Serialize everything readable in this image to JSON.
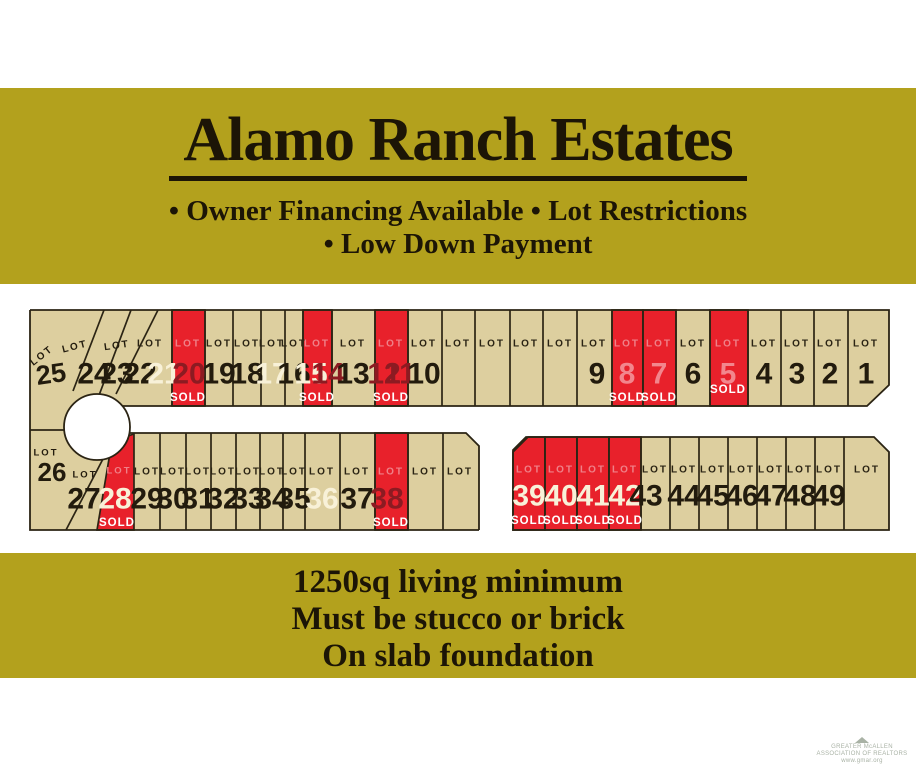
{
  "header": {
    "title": "Alamo Ranch Estates",
    "bullets_line1": "• Owner Financing Available • Lot Restrictions",
    "bullets_line2": "• Low Down Payment"
  },
  "footer_banner": {
    "line1": "1250sq living minimum",
    "line2": "Must be stucco or brick",
    "line3": "On slab foundation"
  },
  "watermark": {
    "line1": "GREATER McALLEN",
    "line2": "ASSOCIATION OF REALTORS",
    "line3": "www.gmar.org"
  },
  "colors": {
    "banner_bg": "#b3a11d",
    "banner_text": "#1c1506",
    "lot_tan": "#ddcf9f",
    "lot_red": "#e8212b",
    "outline": "#2b2414",
    "num_dark": "#221b0d",
    "num_white": "#f8f1d8",
    "num_maroon": "#8c1b22",
    "num_pink": "#f2868d",
    "lot_label_on_red": "#ef8088",
    "sold_text": "#ffffff",
    "watermark": "#a9b2a5",
    "road_white": "#ffffff"
  },
  "map": {
    "lot_word": "LOT",
    "sold_word": "SOLD",
    "sold_lot_numbers": [
      20,
      15,
      14,
      12,
      11,
      8,
      7,
      5,
      28,
      38,
      39,
      40,
      41,
      42
    ],
    "white_number_lots": [
      21,
      17,
      15,
      36
    ],
    "geometry": {
      "tan_polys": [
        "30,310 889,310 889,385 867,406 30,406",
        "30,406 96,406 96,530 30,530",
        "62,433 466,433 479,446 479,530 62,530",
        "526,437 874,437 889,452 889,530 513,530 513,450"
      ],
      "outline_paths": [
        "M30,310 H889 V385 L867,406 H123",
        "M30,310 V530 H479",
        "M129,433 H466 L479,446 V530",
        "M513,450 L526,437 H874 L889,452 V530 H513 Z",
        "M30,430 H64"
      ],
      "slant_lines": [
        [
          104,
          310,
          73,
          391
        ],
        [
          131,
          310,
          95,
          406
        ],
        [
          158,
          310,
          116,
          394
        ],
        [
          104,
          457,
          66,
          530
        ]
      ],
      "red_wedge": "112,441 134,434 134,530 97,530",
      "circle": {
        "cx": 97,
        "cy": 427,
        "r": 33
      }
    },
    "rows": [
      {
        "name": "top-row",
        "y": 310,
        "h": 96,
        "num_y": 374,
        "lot_y": 344,
        "sold_y": 398,
        "dividers": [
          172,
          205,
          233,
          261,
          285,
          303,
          332,
          375,
          408,
          442,
          475,
          510,
          543,
          577,
          612,
          643,
          676,
          710,
          748,
          781,
          814,
          848
        ],
        "red_cells": [
          {
            "x": 172,
            "w": 33
          },
          {
            "x": 303,
            "w": 29
          },
          {
            "x": 375,
            "w": 33
          },
          {
            "x": 612,
            "w": 31
          },
          {
            "x": 643,
            "w": 33
          },
          {
            "x": 710,
            "w": 38,
            "sold_y": 390
          }
        ],
        "lot_labels": [
          {
            "cx": 150
          },
          {
            "cx": 188,
            "on_red": true
          },
          {
            "cx": 219
          },
          {
            "cx": 247
          },
          {
            "cx": 272
          },
          {
            "cx": 294
          },
          {
            "cx": 317,
            "on_red": true
          },
          {
            "cx": 353
          },
          {
            "cx": 391,
            "on_red": true
          },
          {
            "cx": 424
          },
          {
            "cx": 458
          },
          {
            "cx": 492
          },
          {
            "cx": 526
          },
          {
            "cx": 560
          },
          {
            "cx": 594
          },
          {
            "cx": 627,
            "on_red": true
          },
          {
            "cx": 659,
            "on_red": true
          },
          {
            "cx": 693
          },
          {
            "cx": 728,
            "on_red": true
          },
          {
            "cx": 764
          },
          {
            "cx": 797
          },
          {
            "cx": 830
          },
          {
            "cx": 866
          }
        ],
        "numbers": [
          {
            "t": "24",
            "cx": 94,
            "c": "dark"
          },
          {
            "t": "23",
            "cx": 117,
            "c": "dark"
          },
          {
            "t": "22",
            "cx": 140,
            "c": "dark"
          },
          {
            "t": "21",
            "cx": 164,
            "c": "white"
          },
          {
            "t": "20",
            "cx": 189,
            "c": "maroon"
          },
          {
            "t": "19",
            "cx": 219,
            "c": "dark"
          },
          {
            "t": "18",
            "cx": 247,
            "c": "dark"
          },
          {
            "t": "17",
            "cx": 272,
            "c": "white"
          },
          {
            "t": "16",
            "cx": 294,
            "c": "dark"
          },
          {
            "t": "15",
            "cx": 311,
            "c": "white"
          },
          {
            "t": "14",
            "cx": 328,
            "c": "maroon"
          },
          {
            "t": "13",
            "cx": 353,
            "c": "dark"
          },
          {
            "t": "12",
            "cx": 384,
            "c": "maroon"
          },
          {
            "t": "11",
            "cx": 400,
            "c": "maroon"
          },
          {
            "t": "10",
            "cx": 424,
            "c": "dark"
          },
          {
            "t": "9",
            "cx": 597,
            "c": "dark"
          },
          {
            "t": "8",
            "cx": 627,
            "c": "pink"
          },
          {
            "t": "7",
            "cx": 659,
            "c": "pink"
          },
          {
            "t": "6",
            "cx": 693,
            "c": "dark"
          },
          {
            "t": "5",
            "cx": 728,
            "c": "pink"
          },
          {
            "t": "4",
            "cx": 764,
            "c": "dark"
          },
          {
            "t": "3",
            "cx": 797,
            "c": "dark"
          },
          {
            "t": "2",
            "cx": 830,
            "c": "dark"
          },
          {
            "t": "1",
            "cx": 866,
            "c": "dark"
          }
        ],
        "solds": [
          {
            "cx": 188
          },
          {
            "cx": 317
          },
          {
            "cx": 391
          },
          {
            "cx": 627
          },
          {
            "cx": 659
          },
          {
            "cx": 728,
            "y": 390
          }
        ]
      },
      {
        "name": "bottom-left-block",
        "y": 433,
        "h": 97,
        "num_y": 499,
        "lot_y": 472,
        "sold_y": 523,
        "dividers": [
          160,
          186,
          211,
          236,
          260,
          283,
          305,
          340,
          375,
          408,
          443
        ],
        "red_cells": [
          {
            "x": 375,
            "w": 33
          }
        ],
        "lot_labels": [
          {
            "cx": 147
          },
          {
            "cx": 173
          },
          {
            "cx": 198
          },
          {
            "cx": 223
          },
          {
            "cx": 248
          },
          {
            "cx": 272
          },
          {
            "cx": 294
          },
          {
            "cx": 322
          },
          {
            "cx": 357
          },
          {
            "cx": 391,
            "on_red": true
          },
          {
            "cx": 425
          },
          {
            "cx": 460
          }
        ],
        "numbers": [
          {
            "t": "29",
            "cx": 147,
            "c": "dark"
          },
          {
            "t": "30",
            "cx": 173,
            "c": "dark"
          },
          {
            "t": "31",
            "cx": 198,
            "c": "dark"
          },
          {
            "t": "32",
            "cx": 223,
            "c": "dark"
          },
          {
            "t": "33",
            "cx": 248,
            "c": "dark"
          },
          {
            "t": "34",
            "cx": 272,
            "c": "dark"
          },
          {
            "t": "35",
            "cx": 294,
            "c": "dark"
          },
          {
            "t": "36",
            "cx": 322,
            "c": "white"
          },
          {
            "t": "37",
            "cx": 357,
            "c": "dark"
          },
          {
            "t": "38",
            "cx": 387,
            "c": "maroon"
          }
        ],
        "solds": [
          {
            "cx": 391
          }
        ]
      },
      {
        "name": "bottom-right-block",
        "y": 437,
        "h": 93,
        "num_y": 496,
        "lot_y": 470,
        "sold_y": 521,
        "dividers": [
          545,
          577,
          609,
          641,
          670,
          699,
          728,
          757,
          786,
          815,
          844
        ],
        "red_cells": [
          {
            "x": 513,
            "w": 32,
            "clip": "513,452 528,437 545,437 545,530 513,530"
          },
          {
            "x": 545,
            "w": 32
          },
          {
            "x": 577,
            "w": 32
          },
          {
            "x": 609,
            "w": 32
          }
        ],
        "lot_labels": [
          {
            "cx": 529,
            "on_red": true
          },
          {
            "cx": 561,
            "on_red": true
          },
          {
            "cx": 593,
            "on_red": true
          },
          {
            "cx": 625,
            "on_red": true
          },
          {
            "cx": 655
          },
          {
            "cx": 684
          },
          {
            "cx": 713
          },
          {
            "cx": 742
          },
          {
            "cx": 771
          },
          {
            "cx": 800
          },
          {
            "cx": 829
          },
          {
            "cx": 867
          }
        ],
        "numbers": [
          {
            "t": "39",
            "cx": 529,
            "c": "white"
          },
          {
            "t": "40",
            "cx": 561,
            "c": "white"
          },
          {
            "t": "41",
            "cx": 593,
            "c": "white"
          },
          {
            "t": "42",
            "cx": 625,
            "c": "white"
          },
          {
            "t": "43",
            "cx": 646,
            "c": "dark"
          },
          {
            "t": "44",
            "cx": 684,
            "c": "dark"
          },
          {
            "t": "45",
            "cx": 713,
            "c": "dark"
          },
          {
            "t": "46",
            "cx": 742,
            "c": "dark"
          },
          {
            "t": "47",
            "cx": 771,
            "c": "dark"
          },
          {
            "t": "48",
            "cx": 800,
            "c": "dark"
          },
          {
            "t": "49",
            "cx": 829,
            "c": "dark"
          }
        ],
        "solds": [
          {
            "cx": 529
          },
          {
            "cx": 561
          },
          {
            "cx": 593
          },
          {
            "cx": 625
          }
        ]
      }
    ],
    "extra_texts": [
      {
        "t": "LOT",
        "x": 42,
        "y": 356,
        "rot": -38,
        "size": 10,
        "c": "dark",
        "ls": 2,
        "w": 700
      },
      {
        "t": "25",
        "x": 51,
        "y": 374,
        "rot": -8,
        "size": 27,
        "c": "dark"
      },
      {
        "t": "LOT",
        "x": 75,
        "y": 347,
        "rot": -14,
        "size": 10,
        "c": "dark",
        "ls": 2,
        "w": 700
      },
      {
        "t": "LOT",
        "x": 117,
        "y": 346,
        "rot": -8,
        "size": 10,
        "c": "dark",
        "ls": 2,
        "w": 700
      },
      {
        "t": "LOT",
        "x": 46,
        "y": 453,
        "size": 9.5,
        "c": "dark",
        "ls": 2,
        "w": 700
      },
      {
        "t": "26",
        "x": 52,
        "y": 472,
        "size": 26,
        "c": "dark"
      },
      {
        "t": "LOT",
        "x": 85,
        "y": 475,
        "size": 9.5,
        "c": "dark",
        "ls": 2,
        "w": 700
      },
      {
        "t": "27",
        "x": 84,
        "y": 499,
        "size": 30,
        "c": "dark"
      },
      {
        "t": "LOT",
        "x": 119,
        "y": 471,
        "size": 9.5,
        "c": "lotred",
        "ls": 2,
        "w": 700
      },
      {
        "t": "28",
        "x": 115,
        "y": 499,
        "size": 30,
        "c": "white"
      },
      {
        "t": "SOLD",
        "x": 117,
        "y": 523,
        "size": 11.5,
        "c": "soldwhite",
        "ls": 1,
        "w": 700
      }
    ]
  }
}
